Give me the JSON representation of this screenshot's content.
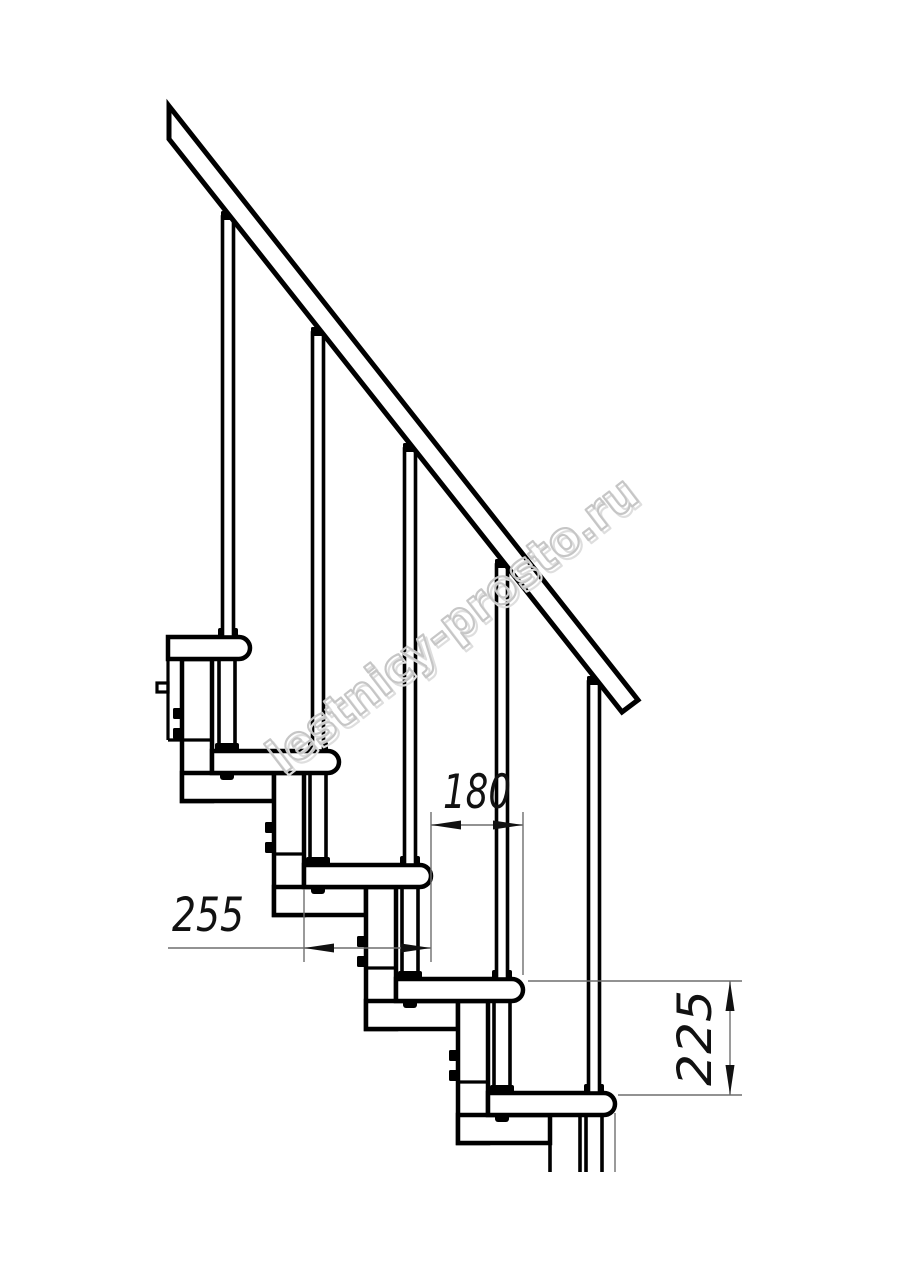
{
  "drawing": {
    "title": "modular-staircase-side-view-technical-drawing",
    "dimensions": {
      "tread_depth": {
        "value": "255"
      },
      "going": {
        "value": "180"
      },
      "rise": {
        "value": "225"
      }
    },
    "watermark": {
      "text": "lestnicy-prosto.ru",
      "color": "#c6c6c6",
      "shadow_color": "#dedede"
    },
    "colors": {
      "line": "#000000",
      "dimension_line": "#6e6e6e",
      "background": "#ffffff"
    }
  }
}
